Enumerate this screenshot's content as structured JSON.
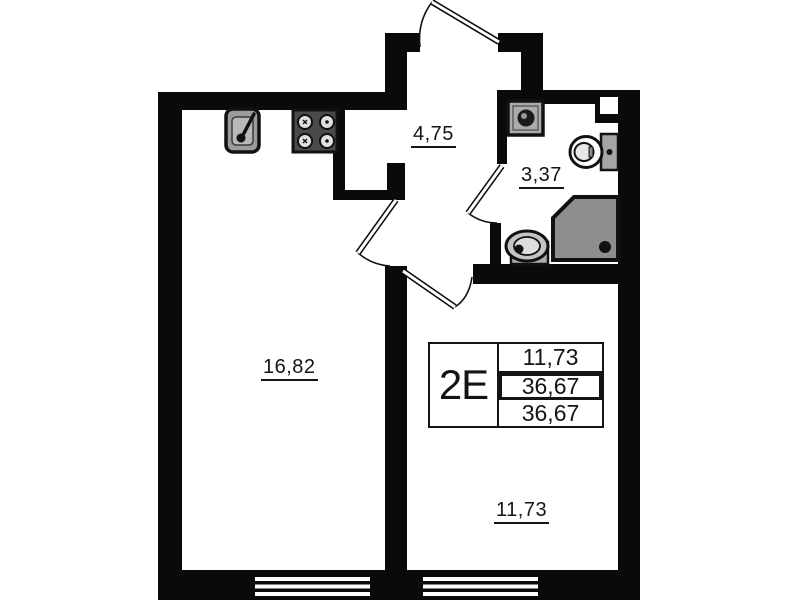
{
  "title": "Apartment floor plan 2E",
  "colors": {
    "wall": "#0a0a0a",
    "background": "#ffffff",
    "fixture_gray": "#a8a8a8",
    "shower_gray": "#8e8e8e"
  },
  "rooms": [
    {
      "name": "kitchen-living-room",
      "area": "16,82"
    },
    {
      "name": "hallway",
      "area": "4,75"
    },
    {
      "name": "bathroom",
      "area": "3,37"
    },
    {
      "name": "bedroom",
      "area": "11,73"
    }
  ],
  "info_table": {
    "unit_label": "2E",
    "rows": [
      "11,73",
      "36,67",
      "36,67"
    ]
  },
  "fixtures": [
    "kitchen-sink-icon",
    "stove-icon",
    "washing-machine-icon",
    "toilet-icon",
    "shower-icon",
    "bathroom-sink-icon",
    "entrance-door",
    "kitchen-door",
    "bathroom-door",
    "bedroom-door",
    "window-left",
    "window-right",
    "vent-shaft"
  ]
}
